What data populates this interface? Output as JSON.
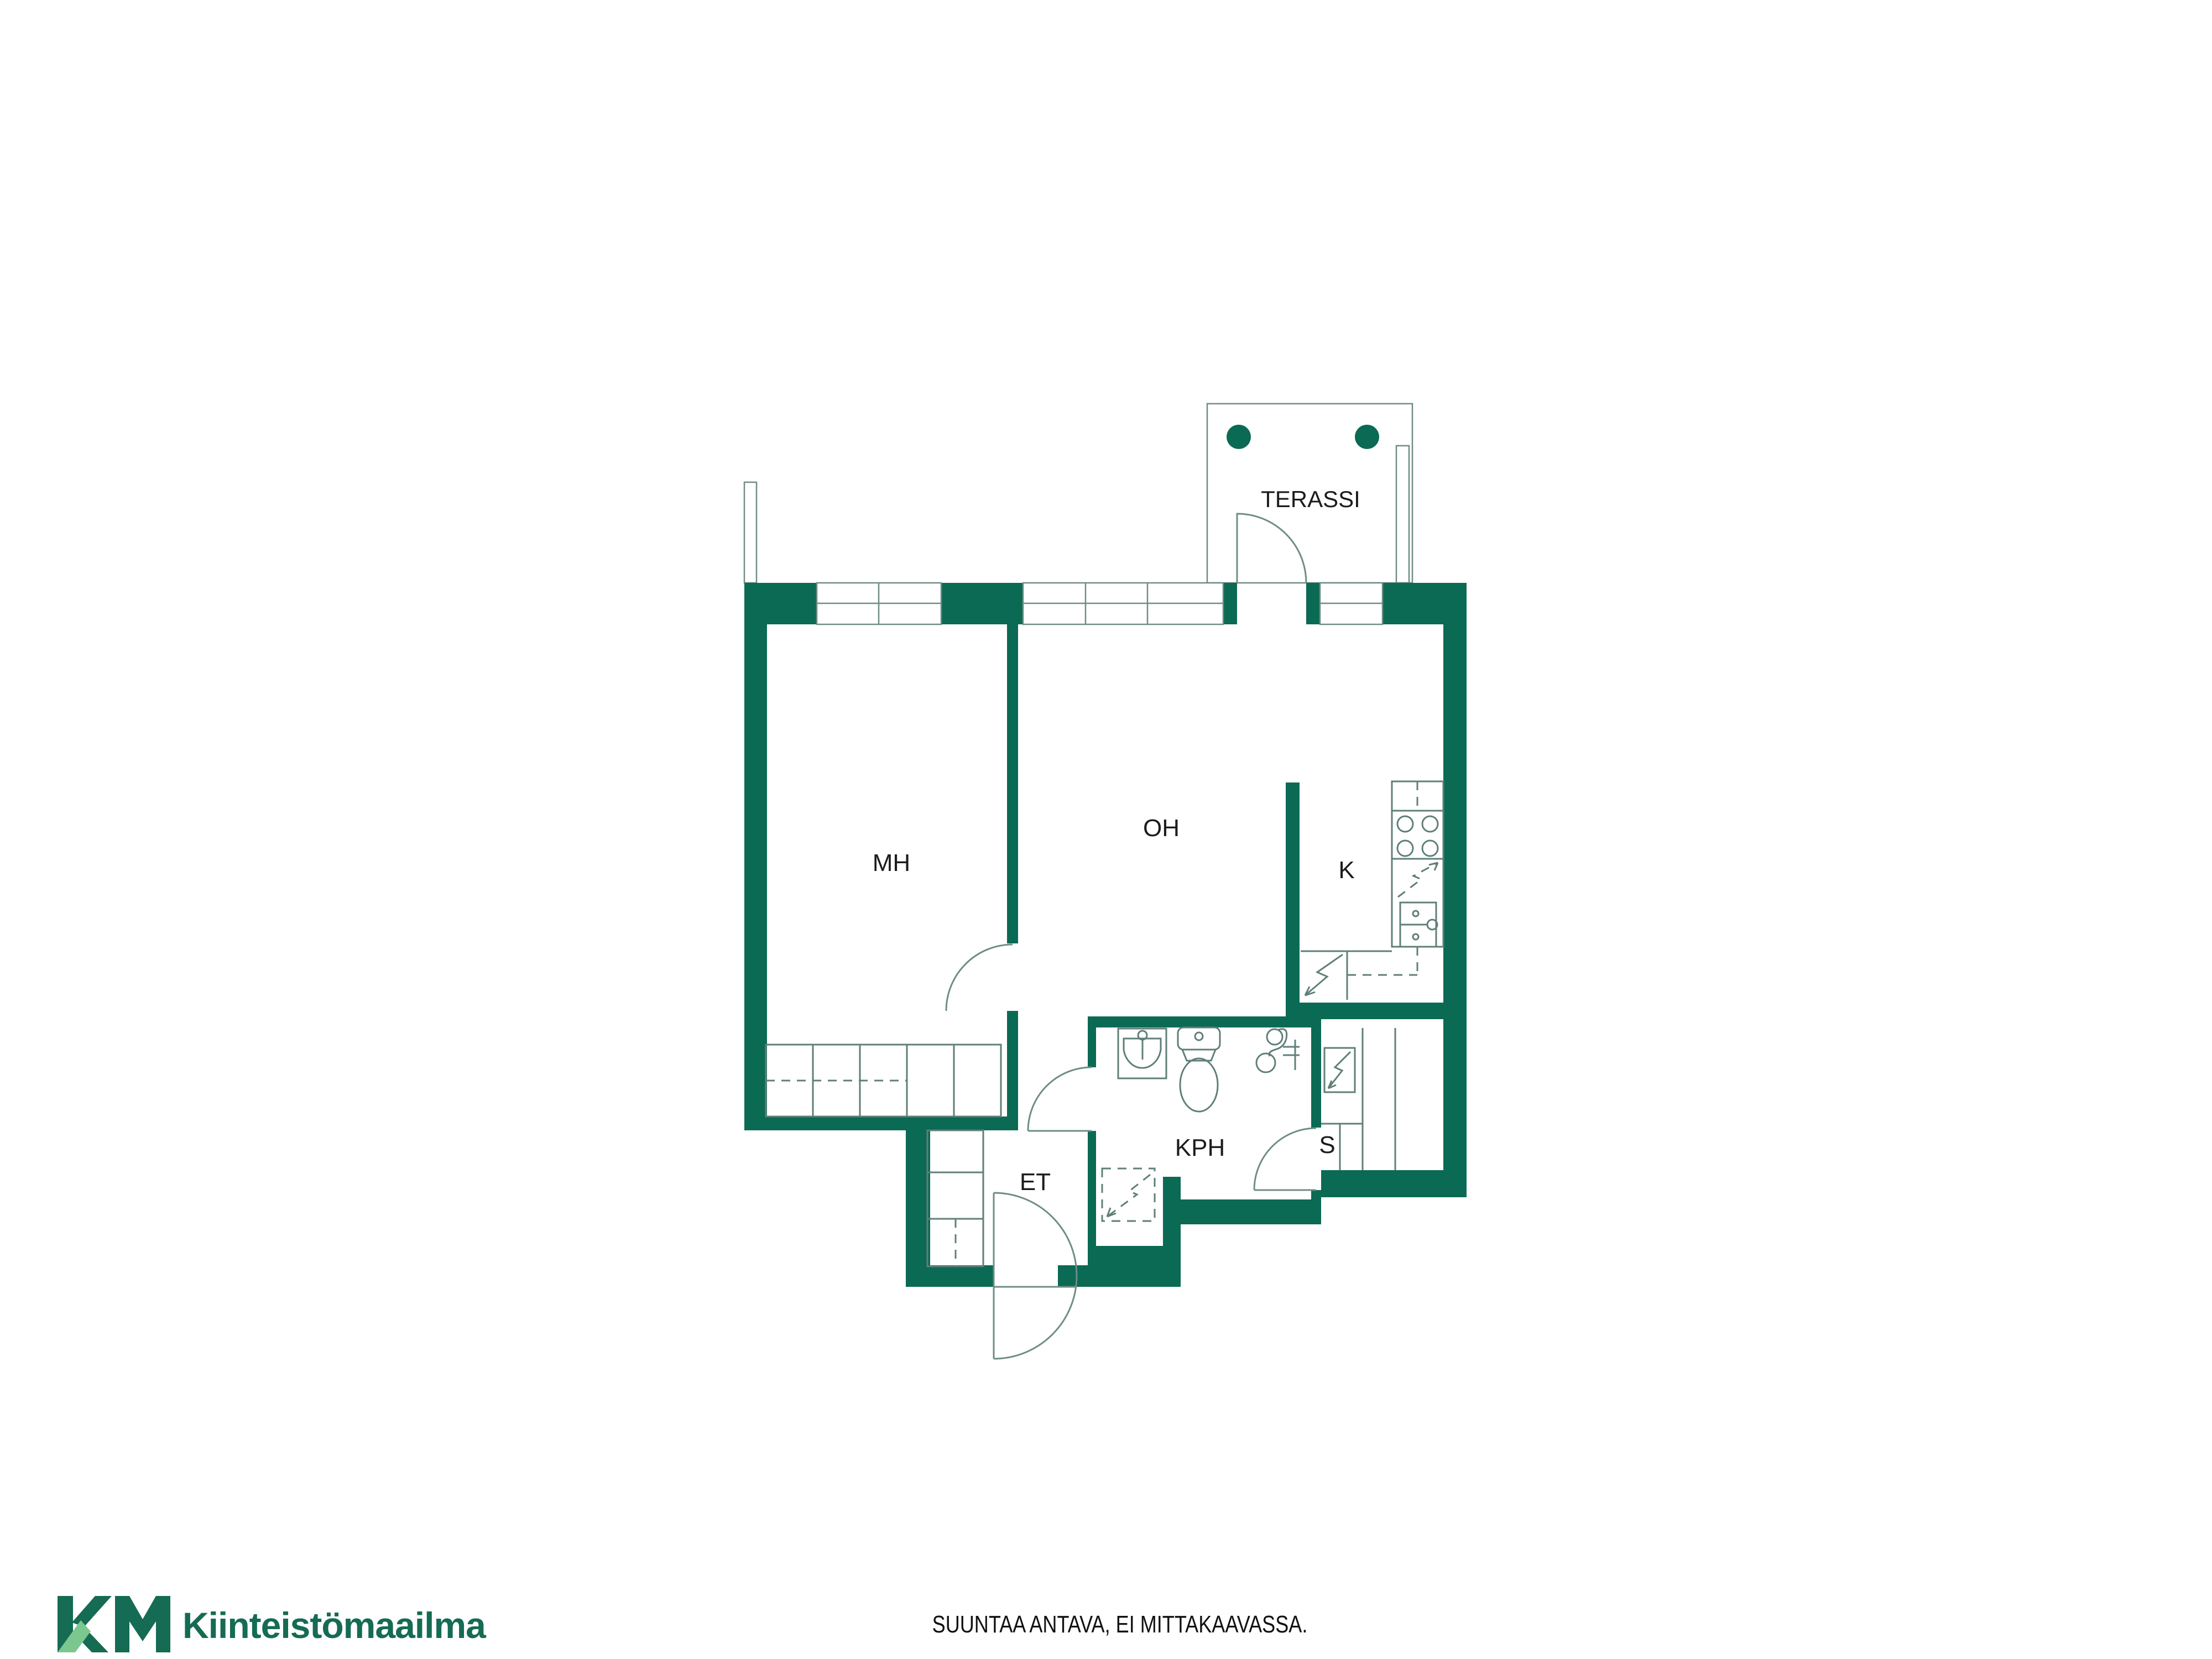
{
  "colors": {
    "wall": "#0b6a54",
    "logo_dark": "#156b53",
    "logo_light": "#7cc690",
    "line": "#6f8d85",
    "label": "#1c1c1c"
  },
  "rooms": {
    "terassi": "TERASSI",
    "mh": "MH",
    "oh": "OH",
    "k": "K",
    "kph": "KPH",
    "s": "S",
    "et": "ET"
  },
  "footer": {
    "disclaimer": "SUUNTAA ANTAVA, EI MITTAKAAVASSA."
  },
  "logo": {
    "monogram": "KM",
    "text": "Kiinteistömaailma"
  }
}
